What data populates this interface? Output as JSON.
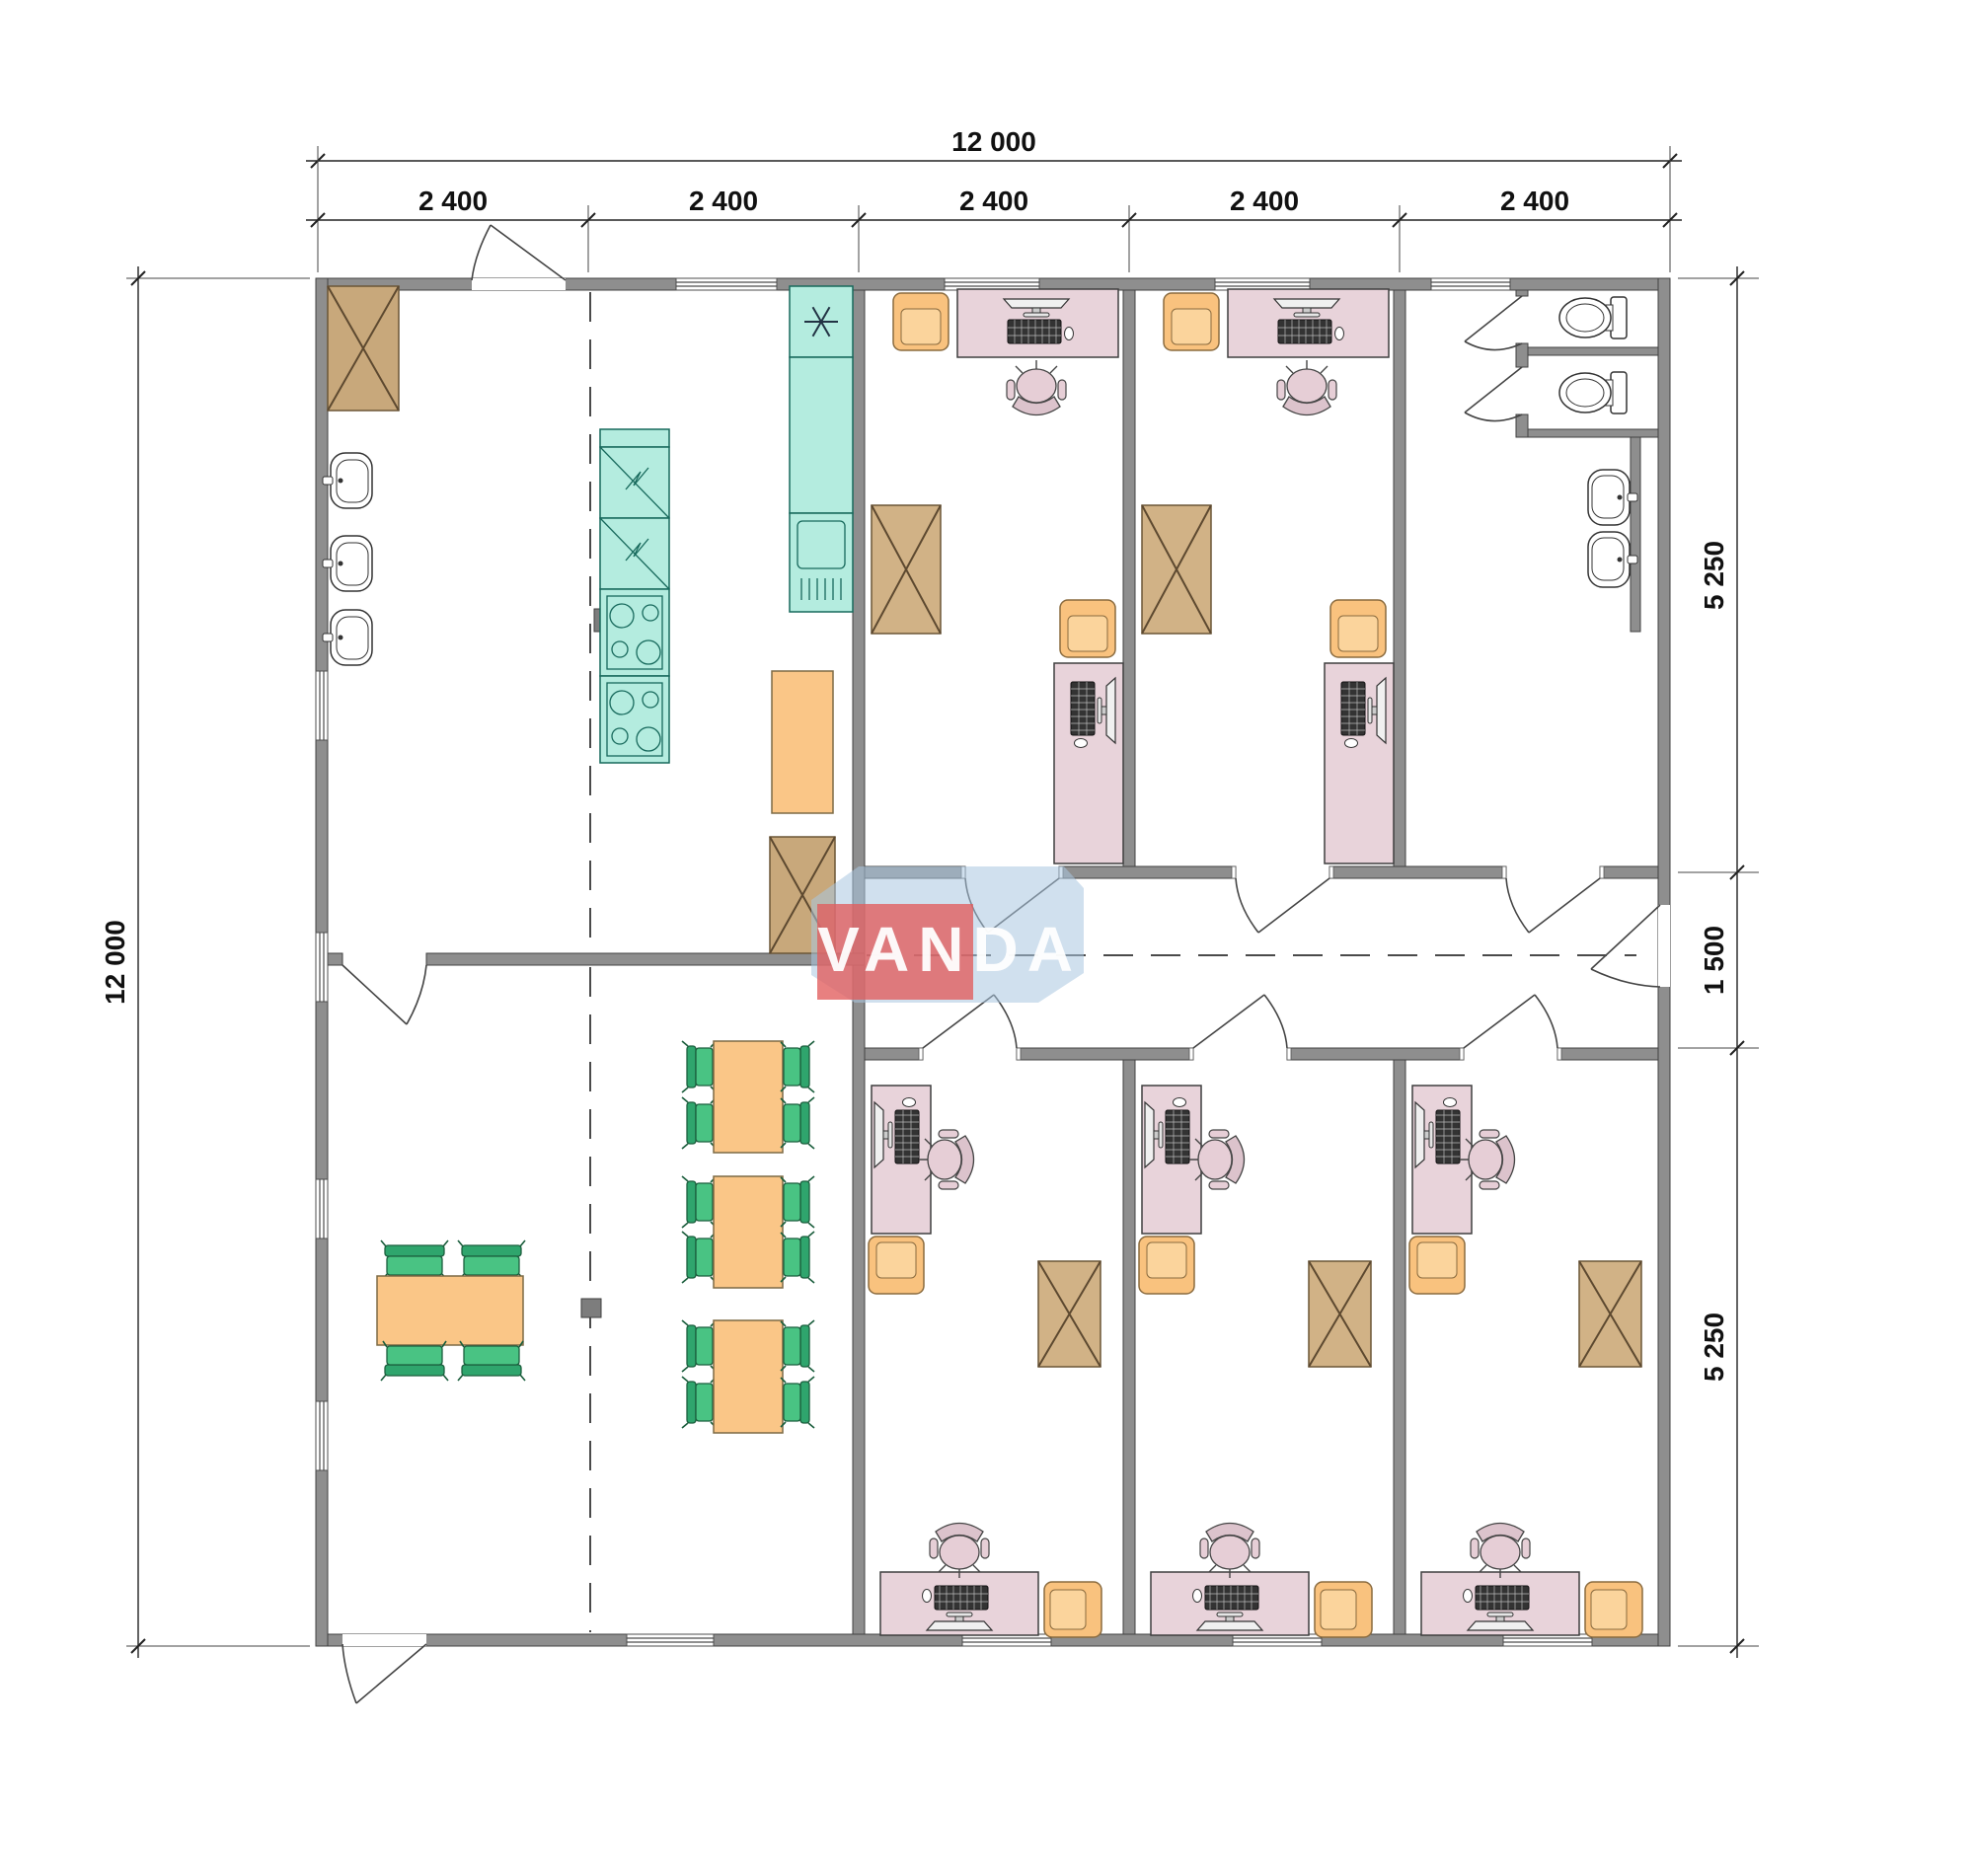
{
  "title": "Modular office building floor plan 12000 x 12000",
  "dimensions": {
    "top_total": "12 000",
    "top_segments": [
      "2 400",
      "2 400",
      "2 400",
      "2 400",
      "2 400"
    ],
    "left_total": "12 000",
    "right_segments": [
      "5 250",
      "1 500",
      "5 250"
    ]
  },
  "logo": {
    "text": "VANDA",
    "red": "#e25c5c",
    "blue": "#a9c6e0",
    "text_color": "#ffffff"
  },
  "colors": {
    "wall": "#8e8e8e",
    "desk_pink": "#e8d3da",
    "furniture_orange": "#fac687",
    "chair_green": "#49c383",
    "kitchen_teal": "#b4ecdf",
    "wardrobe_tan": "#d1b286",
    "dimension_text": "#111111"
  },
  "plan": {
    "overall_width": "12 000",
    "overall_height": "12 000",
    "module_count": 5,
    "rooms": [
      {
        "name": "entrance-hall-kitchen",
        "fixtures": [
          "wardrobe",
          "wash-basin",
          "wash-basin",
          "wash-basin",
          "fridge",
          "fridge",
          "cooktop",
          "cooktop",
          "counter-with-sink",
          "dishwasher",
          "serving-table",
          "wardrobe",
          "structural-column"
        ]
      },
      {
        "name": "dining-room",
        "fixtures": [
          "table-with-4-chairs",
          "table-with-4-chairs",
          "table-with-4-chairs",
          "table-with-4-chairs",
          "structural-column"
        ]
      },
      {
        "name": "office-top-1",
        "fixtures": [
          "desk-with-computer",
          "task-chair",
          "guest-armchair",
          "wardrobe",
          "desk-with-computer",
          "guest-armchair"
        ]
      },
      {
        "name": "office-top-2",
        "fixtures": [
          "desk-with-computer",
          "task-chair",
          "guest-armchair",
          "wardrobe",
          "desk-with-computer",
          "guest-armchair"
        ]
      },
      {
        "name": "wc-lobby",
        "fixtures": [
          "toilet-cabin",
          "toilet-cabin",
          "wash-basin",
          "wash-basin"
        ]
      },
      {
        "name": "corridor",
        "fixtures": []
      },
      {
        "name": "office-bottom-1",
        "fixtures": [
          "desk-with-computer",
          "task-chair",
          "guest-armchair",
          "wardrobe",
          "desk-with-computer",
          "task-chair",
          "guest-armchair"
        ]
      },
      {
        "name": "office-bottom-2",
        "fixtures": [
          "desk-with-computer",
          "task-chair",
          "guest-armchair",
          "wardrobe",
          "desk-with-computer",
          "task-chair",
          "guest-armchair"
        ]
      },
      {
        "name": "office-bottom-3",
        "fixtures": [
          "desk-with-computer",
          "task-chair",
          "guest-armchair",
          "wardrobe",
          "desk-with-computer",
          "task-chair",
          "guest-armchair"
        ]
      }
    ]
  }
}
